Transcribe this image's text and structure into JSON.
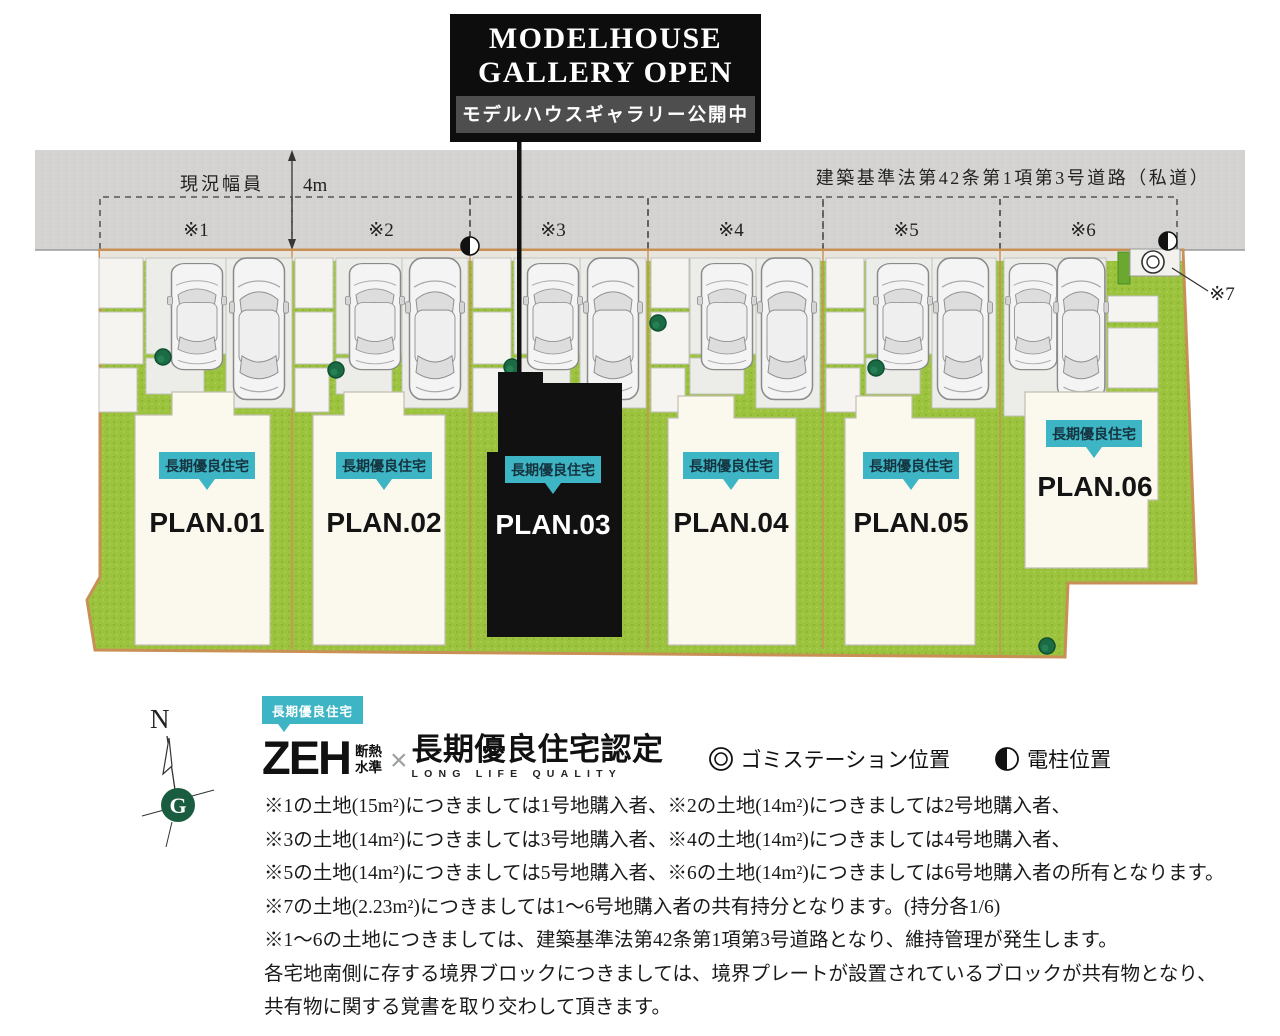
{
  "banner": {
    "line1": "MODELHOUSE",
    "line2": "GALLERY OPEN",
    "subtitle": "モデルハウスギャラリー公開中"
  },
  "road": {
    "width_label": "現況幅員",
    "width_value": "4m",
    "name": "建築基準法第42条第1項第3号道路（私道）",
    "markers": [
      "※1",
      "※2",
      "※3",
      "※4",
      "※5",
      "※6"
    ],
    "marker7": "※7"
  },
  "plots": [
    {
      "badge": "長期優良住宅",
      "label": "PLAN.01"
    },
    {
      "badge": "長期優良住宅",
      "label": "PLAN.02"
    },
    {
      "badge": "長期優良住宅",
      "label": "PLAN.03"
    },
    {
      "badge": "長期優良住宅",
      "label": "PLAN.04"
    },
    {
      "badge": "長期優良住宅",
      "label": "PLAN.05"
    },
    {
      "badge": "長期優良住宅",
      "label": "PLAN.06"
    }
  ],
  "legend": {
    "badge": "長期優良住宅",
    "zeh": "ZEH",
    "zeh_sub_top": "断熱",
    "zeh_sub_bottom": "水準",
    "cross": "×",
    "cert_title": "長期優良住宅認定",
    "cert_sub": "LONG LIFE QUALITY",
    "garbage_label": "ゴミステーション位置",
    "pole_label": "電柱位置"
  },
  "compass": {
    "north": "N",
    "logo": "G"
  },
  "notes": [
    "※1の土地(15m²)につきましては1号地購入者、※2の土地(14m²)につきましては2号地購入者、",
    "※3の土地(14m²)につきましては3号地購入者、※4の土地(14m²)につきましては4号地購入者、",
    "※5の土地(14m²)につきましては5号地購入者、※6の土地(14m²)につきましては6号地購入者の所有となります。",
    "※7の土地(2.23m²)につきましては1～6号地購入者の共有持分となります。(持分各1/6)",
    "※1～6の土地につきましては、建築基準法第42条第1項第3号道路となり、維持管理が発生します。",
    "各宅地南側に存する境界ブロックにつきましては、境界プレートが設置されているブロックが共有物となり、",
    "共有物に関する覚書を取り交わして頂きます。"
  ],
  "colors": {
    "accent_teal": "#3eb5c5",
    "grass_green": "#9cc33d",
    "road_gray": "#d4d3d1",
    "boundary_tan": "#c89055",
    "model_black": "#111111",
    "house_cream": "#fbf9ee"
  }
}
